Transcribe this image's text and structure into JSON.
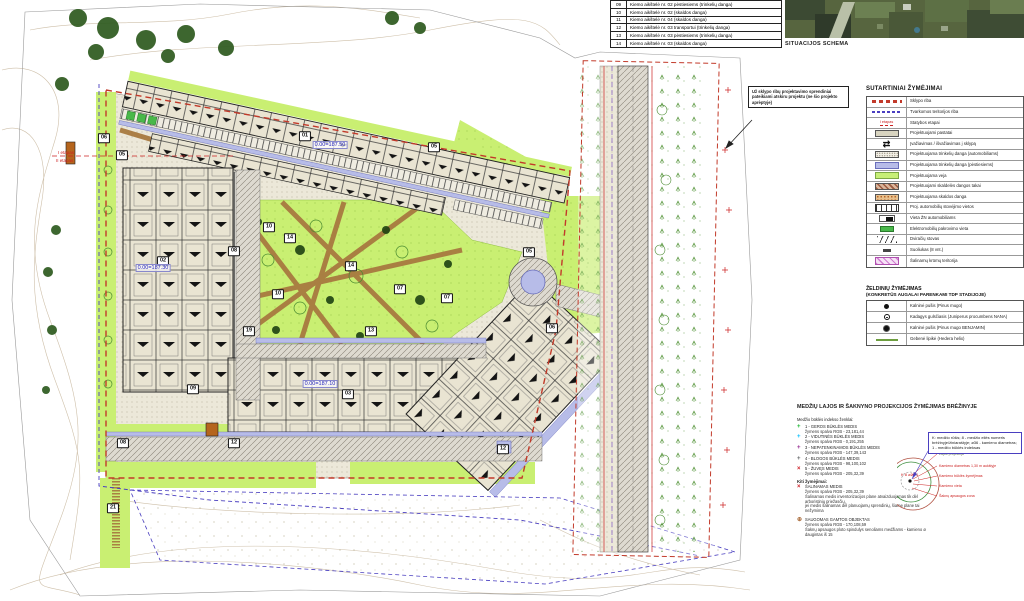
{
  "colors": {
    "boundary_red": "#c23a2a",
    "managed_boundary_blue": "#4a3fc0",
    "lawn_green": "#c7ef77",
    "paver_pedestrian": "#b7bce8",
    "gravel_path_brown": "#a87a40",
    "index1_green": "rgb(23,181,44)",
    "index2_cyan": "rgb(0,191,255)",
    "index3_purple": "rgb(147,39,143)",
    "index4_gray": "rgb(98,100,102)",
    "index5_red": "rgb(205,32,39)",
    "protected_brown": "rgb(170,108,59)"
  },
  "yard_table": {
    "rows": [
      {
        "num": "09",
        "label": "Kiemo aikštelė nr. 02 pėstiesiems (trinkelių danga)"
      },
      {
        "num": "10",
        "label": "Kiemo aikštelė nr. 02 (skaldos danga)"
      },
      {
        "num": "11",
        "label": "Kiemo aikštelė nr. 04 (skaldos danga)"
      },
      {
        "num": "12",
        "label": "Kiemo aikštelė nr. 03 transportui (trinkelių danga)"
      },
      {
        "num": "13",
        "label": "Kiemo aikštelė nr. 03 pėstiesiems (trinkelių danga)"
      },
      {
        "num": "14",
        "label": "Kiemo aikštelė nr. 03 (skaldos danga)"
      }
    ]
  },
  "situation": {
    "label": "SITUACIJOS SCHEMA"
  },
  "note_box": {
    "text": "Už sklypo ribų projektavimo sprendiniai pateikiami atskiru projektu (ne šio projekto aprėptyje)"
  },
  "legend": {
    "title": "SUTARTINIAI ŽYMĖJIMAI",
    "rows": [
      {
        "symbol": "sklypo-riba",
        "label": "Sklypo riba"
      },
      {
        "symbol": "tvarkomos-riba",
        "label": "Tvarkomos teritorijos riba"
      },
      {
        "symbol": "statybos-etapai",
        "symbol_text": "I etapas",
        "label": "Statybos etapai"
      },
      {
        "symbol": "pastatai",
        "label": "Projektuojami pastatai"
      },
      {
        "symbol": "ivaziavimas",
        "symbol_text": "⇄",
        "label": "Įvažiavimas / išvažiavimas į sklypą"
      },
      {
        "symbol": "trinkeliu-auto",
        "label": "Projektuojama trinkelių danga (automobiliams)"
      },
      {
        "symbol": "trinkeliu-pest",
        "label": "Projektuojama trinkelių danga (pėstiesiems)"
      },
      {
        "symbol": "veja",
        "label": "Projektuojama veja"
      },
      {
        "symbol": "skaldeles-takai",
        "label": "Projektuojami skaldelės dangos takai"
      },
      {
        "symbol": "skaldos-danga",
        "label": "Projektuojama skaldos danga"
      },
      {
        "symbol": "parking",
        "label": "Proj. automobilių stovėjimo vietos"
      },
      {
        "symbol": "zn-vieta",
        "label": "Vieta ŽN automobiliams"
      },
      {
        "symbol": "elektro",
        "label": "Elektromobilių pakrovimo vieta"
      },
      {
        "symbol": "dviraciu",
        "label": "Dviračių stovas"
      },
      {
        "symbol": "suoliukas",
        "label": "Suoliukas (8 vnt.)"
      },
      {
        "symbol": "krumai",
        "label": "Šalinamų krūmų teritorija"
      }
    ]
  },
  "planting": {
    "title": "ŽELDINIŲ ŽYMĖJIMAS",
    "subtitle": "(KONKRETŪS AUGALAI PARENKAMI TDP STADIJOJE)",
    "rows": [
      {
        "symbol": "pine-small",
        "label": "Kalninė pušis (Pinus mugo)"
      },
      {
        "symbol": "juniper",
        "label": "Kadagys gulsčiasis (Juniperus procumbens NANA)"
      },
      {
        "symbol": "pine-big",
        "label": "Kalninė pušis (Pinus mugo BENJAMIN)"
      },
      {
        "symbol": "hedera",
        "label": "Gebenė lipikė (Hedera helix)"
      }
    ]
  },
  "trees": {
    "title": "MEDŽIŲ LAJOS IR ŠAKNYNO PROJEKCIJOS ŽYMĖJIMAS BRĖŽINYJE",
    "intro": "Medžio būklės indekso ženklai:",
    "index_items": [
      {
        "glyph": "+",
        "color": "rgb(23,181,44)",
        "main": "1 - GEROS BŪKLĖS MEDIS",
        "sub": "žymens spalva RGB - 23,181,44"
      },
      {
        "glyph": "+",
        "color": "rgb(0,191,255)",
        "main": "2 - VIDUTINĖS BŪKLĖS MEDIS",
        "sub": "žymens spalva RGB - 0,191,255"
      },
      {
        "glyph": "+",
        "color": "rgb(147,39,143)",
        "main": "3 - NEPATENKINAMOS BŪKLĖS MEDIS",
        "sub": "žymens spalva RGB - 147,39,143"
      },
      {
        "glyph": "+",
        "color": "rgb(98,100,102)",
        "main": "4 - BLOGOS BŪKLĖS MEDIS",
        "sub": "žymens spalva RGB - 98,100,102"
      },
      {
        "glyph": "×",
        "color": "rgb(205,32,39)",
        "main": "5 - ŽUVĘS MEDIS",
        "sub": "žymens spalva RGB - 205,32,39"
      }
    ],
    "kiti_title": "Kiti žymėjimai:",
    "salinamas": {
      "glyph": "×",
      "color": "rgb(205,32,39)",
      "main": "ŠALINAMAS MEDIS",
      "sub": "žymens spalva RGB - 205,32,39",
      "note1": "Šalinamas medis inventorizacijos plane atvaizduojamas tik dėl arboristinių priežasčių,",
      "note2": "jei medis šalinamas dėl planuojamų sprendinių, šiame plane tai nežymima"
    },
    "saugomas": {
      "glyph": "⊕",
      "color": "rgb(170,108,59)",
      "main": "SAUGOMAS GAMTOS OBJEKTAS",
      "sub": "žymens spalva RGB - 170,108,59",
      "note": "Šaknų apsaugos ploto spindulys senoliams medžiams - kamieno ø daugintas iš 15"
    },
    "callout": "K: medžio rūšis; 8 - medžio eilės numeris brėžinyje/žiniaraštyje; ø36 - kamieno diametras; 1 - medžio būklės indeksas",
    "diagram_labels": [
      "Lajos projekcija",
      "Kamieno diametras 1,30 m aukštyje",
      "Kamieno būklės žymėjimas",
      "Kamieno vieta",
      "Šaknų apsaugos zona"
    ],
    "diagram_tag": "K 8 ø36 1"
  },
  "plan": {
    "markers": [
      {
        "label": "06",
        "x": 104,
        "y": 138
      },
      {
        "label": "05",
        "x": 122,
        "y": 155
      },
      {
        "label": "01",
        "x": 305,
        "y": 136
      },
      {
        "label": "05",
        "x": 434,
        "y": 147
      },
      {
        "label": "02",
        "x": 163,
        "y": 261
      },
      {
        "label": "08",
        "x": 234,
        "y": 251
      },
      {
        "label": "09",
        "x": 193,
        "y": 389
      },
      {
        "label": "10",
        "x": 269,
        "y": 227
      },
      {
        "label": "14",
        "x": 290,
        "y": 238
      },
      {
        "label": "14",
        "x": 351,
        "y": 266
      },
      {
        "label": "10",
        "x": 278,
        "y": 294
      },
      {
        "label": "07",
        "x": 400,
        "y": 289
      },
      {
        "label": "07",
        "x": 447,
        "y": 298
      },
      {
        "label": "13",
        "x": 371,
        "y": 331
      },
      {
        "label": "19",
        "x": 249,
        "y": 331
      },
      {
        "label": "05",
        "x": 529,
        "y": 252
      },
      {
        "label": "06",
        "x": 552,
        "y": 328
      },
      {
        "label": "03",
        "x": 348,
        "y": 394
      },
      {
        "label": "08",
        "x": 123,
        "y": 443
      },
      {
        "label": "12",
        "x": 234,
        "y": 443
      },
      {
        "label": "12",
        "x": 503,
        "y": 449
      },
      {
        "label": "21",
        "x": 113,
        "y": 508
      }
    ],
    "elevations": [
      {
        "text": "0.00=187.50",
        "x": 330,
        "y": 145
      },
      {
        "text": "0.00=187.30",
        "x": 153,
        "y": 268
      },
      {
        "text": "0.00=187.10",
        "x": 320,
        "y": 384
      }
    ],
    "etapas": [
      {
        "text": "I etapas",
        "x": 58,
        "y": 150
      },
      {
        "text": "II etapas",
        "x": 56,
        "y": 158
      }
    ]
  }
}
